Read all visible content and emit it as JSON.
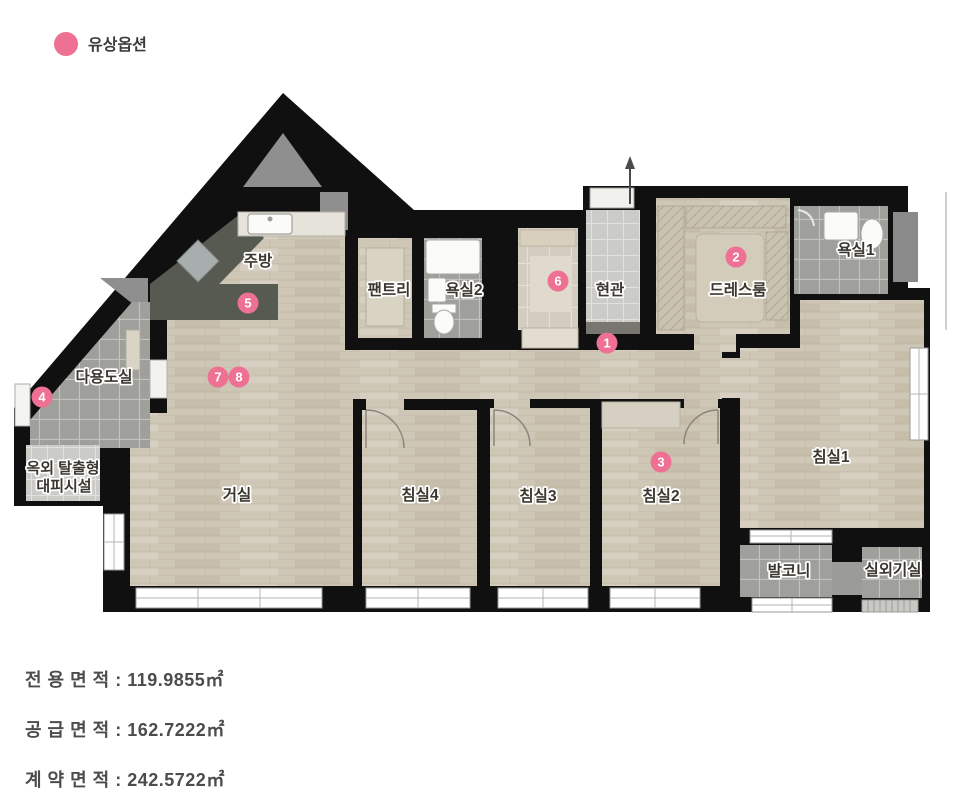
{
  "legend": {
    "label": "유상옵션",
    "color": "#ee7093"
  },
  "plan": {
    "rooms": [
      {
        "id": "kitchen",
        "label": "주방"
      },
      {
        "id": "pantry",
        "label": "팬트리"
      },
      {
        "id": "bath2",
        "label": "욕실2"
      },
      {
        "id": "entrance",
        "label": "현관"
      },
      {
        "id": "dressroom",
        "label": "드레스룸"
      },
      {
        "id": "bath1",
        "label": "욕실1"
      },
      {
        "id": "utility",
        "label": "다용도실"
      },
      {
        "id": "living",
        "label": "거실"
      },
      {
        "id": "bedroom4",
        "label": "침실4"
      },
      {
        "id": "bedroom3",
        "label": "침실3"
      },
      {
        "id": "bedroom2",
        "label": "침실2"
      },
      {
        "id": "bedroom1",
        "label": "침실1"
      },
      {
        "id": "balcony",
        "label": "발코니"
      },
      {
        "id": "ac-room",
        "label": "실외기실"
      },
      {
        "id": "shelter",
        "label": "옥외 탈출형",
        "label2": "대피시설"
      }
    ],
    "markers": [
      {
        "n": "1"
      },
      {
        "n": "2"
      },
      {
        "n": "3"
      },
      {
        "n": "4"
      },
      {
        "n": "5"
      },
      {
        "n": "6"
      },
      {
        "n": "7"
      },
      {
        "n": "8"
      }
    ]
  },
  "areas": [
    {
      "label": "전 용 면 적 : 119.9855㎡"
    },
    {
      "label": "공 급 면 적 : 162.7222㎡"
    },
    {
      "label": "계 약 면 적 : 242.5722㎡"
    }
  ],
  "colors": {
    "accent": "#ee7093",
    "wall": "#101010",
    "wood": "#cfc7b6",
    "tile_gray": "#9fa09b",
    "counter": "#565a50"
  }
}
